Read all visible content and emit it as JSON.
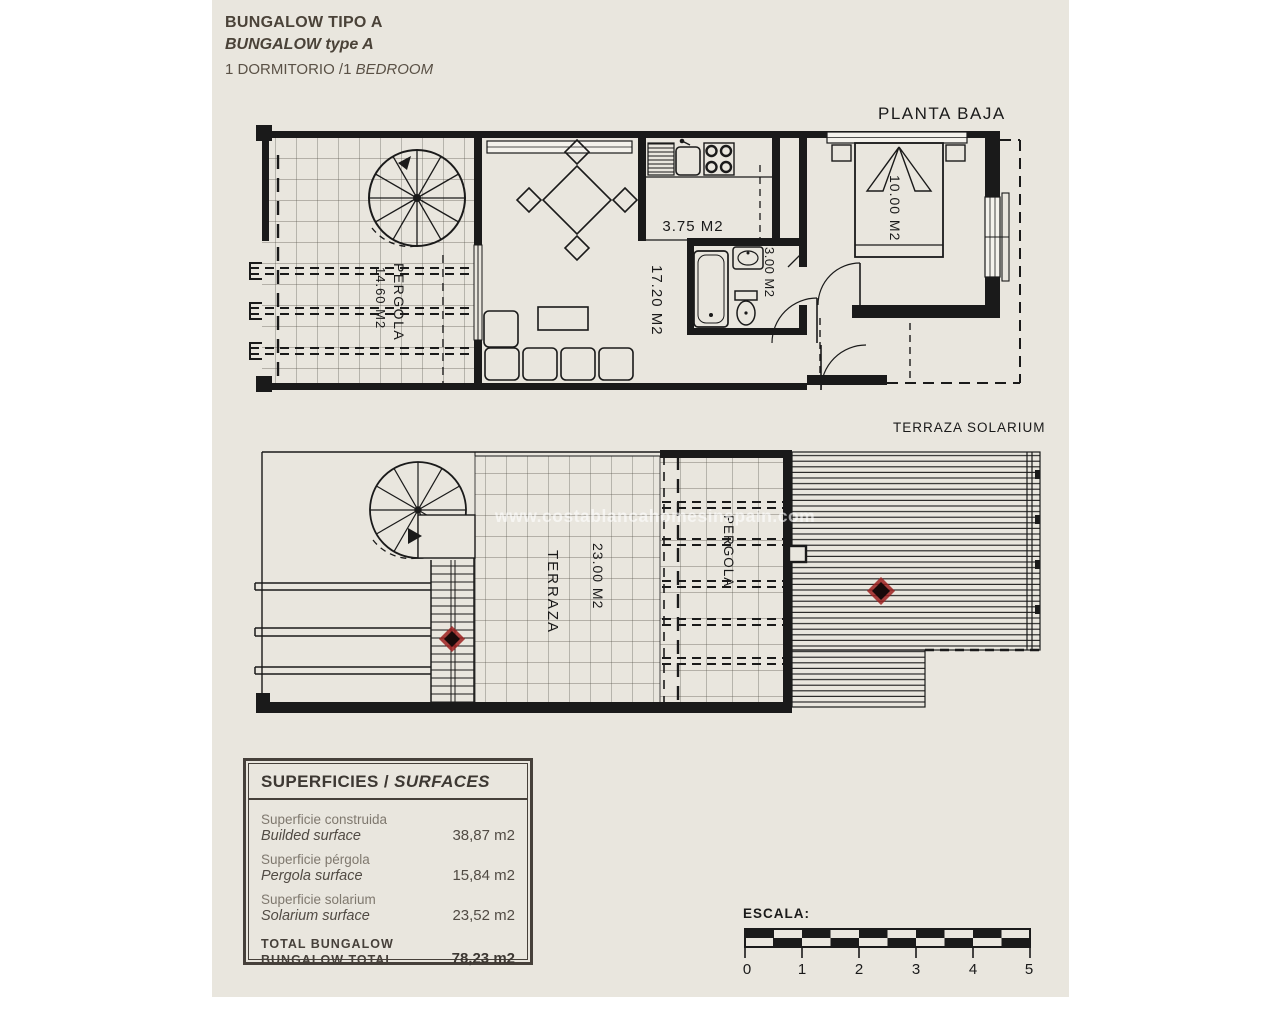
{
  "paper": {
    "background": "#e9e6de",
    "line_color": "#1a1a1a",
    "marker_color": "#8e1d1d"
  },
  "header": {
    "line1": "BUNGALOW TIPO A",
    "line2": "BUNGALOW type A",
    "line3_regular": "1 DORMITORIO /1 ",
    "line3_italic": "BEDROOM"
  },
  "ground_plan": {
    "title": "PLANTA BAJA",
    "pergola_label": "PERGOLA",
    "pergola_area": "14.60 M2",
    "living_area": "17.20 M2",
    "kitchen_area": "3.75 M2",
    "bathroom_area": "3.00 M2",
    "bedroom_area": "10.00 M2"
  },
  "roof_plan": {
    "title": "TERRAZA SOLARIUM",
    "terraza_label": "TERRAZA",
    "terraza_area": "23.00 M2",
    "pergola_label": "PERGOLA"
  },
  "watermark": "www.costablancahomesinspain.com",
  "surfaces": {
    "heading_es": "SUPERFICIES / ",
    "heading_en": "SURFACES",
    "rows": [
      {
        "es": "Superficie construida",
        "en": "Builded surface",
        "value": "38,87 m2"
      },
      {
        "es": "Superficie pérgola",
        "en": "Pergola surface",
        "value": "15,84 m2"
      },
      {
        "es": "Superficie solarium",
        "en": "Solarium surface",
        "value": "23,52 m2"
      }
    ],
    "total_es": "TOTAL BUNGALOW",
    "total_en": "BUNGALOW TOTAL",
    "total_value": "78,23 m2"
  },
  "scale_bar": {
    "label": "ESCALA:",
    "ticks": [
      "0",
      "1",
      "2",
      "3",
      "4",
      "5"
    ]
  }
}
